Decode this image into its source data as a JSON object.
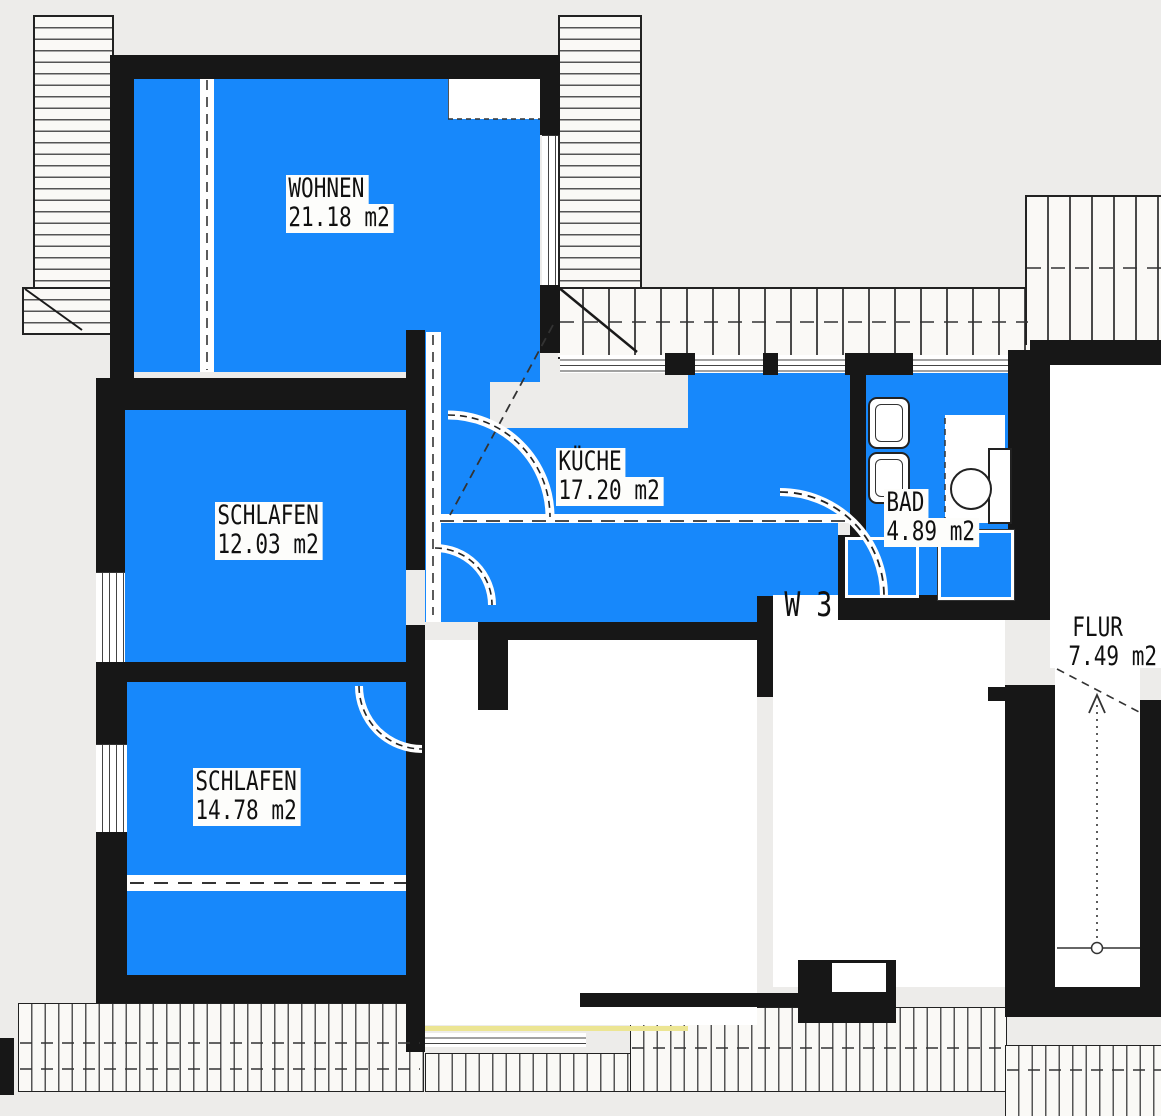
{
  "plan": {
    "title": "Dachgeschoss Wohnungsplan",
    "unit_label": "W 3",
    "rooms": [
      {
        "name": "WOHNEN",
        "area": "21.18 m2"
      },
      {
        "name": "SCHLAFEN",
        "area": "12.03 m2"
      },
      {
        "name": "SCHLAFEN",
        "area": "14.78 m2"
      },
      {
        "name": "KÜCHE",
        "area": "17.20 m2"
      },
      {
        "name": "BAD",
        "area": "4.89 m2"
      },
      {
        "name": "FLUR",
        "area": "7.49 m2"
      }
    ],
    "colors": {
      "highlight": "#1788fb",
      "wall": "#171717",
      "paper": "#edecea"
    }
  }
}
